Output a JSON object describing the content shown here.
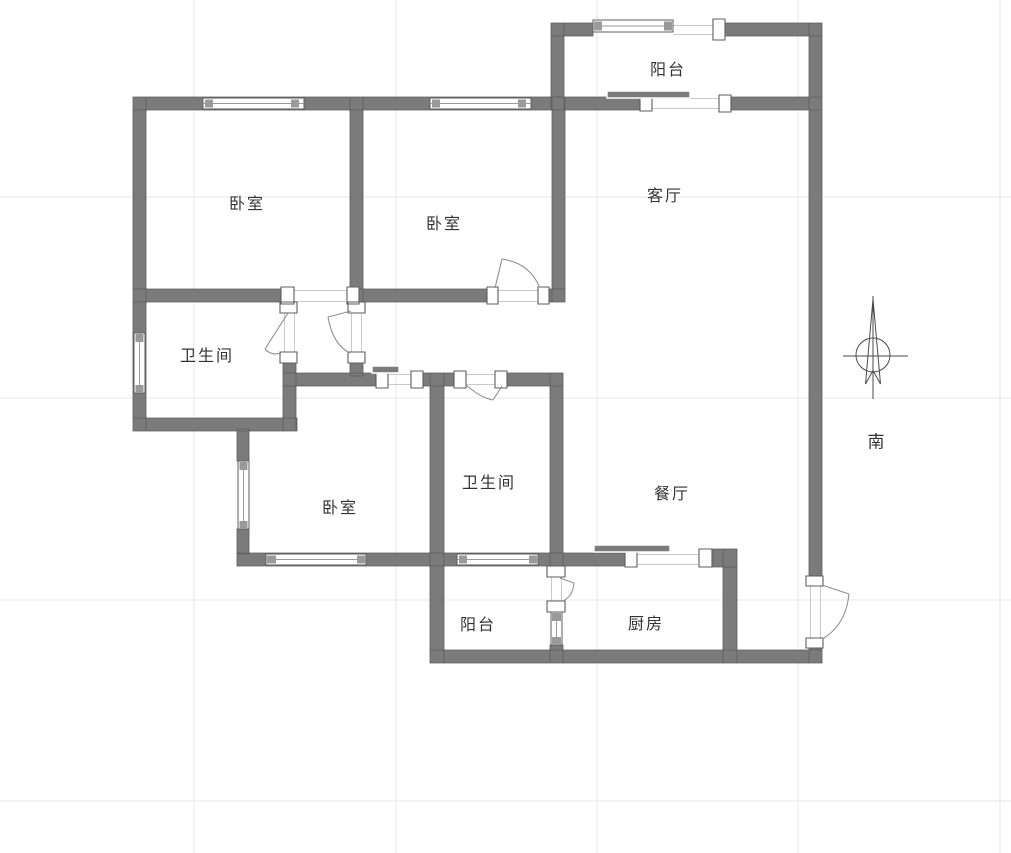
{
  "rooms": {
    "balcony_top": "阳台",
    "bedroom_top_left": "卧室",
    "bedroom_top_middle": "卧室",
    "living_room": "客厅",
    "bathroom_left": "卫生间",
    "bedroom_bottom": "卧室",
    "bathroom_middle": "卫生间",
    "dining_room": "餐厅",
    "balcony_bottom": "阳台",
    "kitchen": "厨房"
  },
  "compass": {
    "south_label": "南"
  },
  "colors": {
    "wall": "#7b7b7b",
    "wall-edge": "#5e5e5e",
    "opening-line": "#c9c9c9",
    "door-line": "#8f8f8f",
    "window-cap": "#9a9a9a",
    "grid": "#e7e7e7",
    "text": "#333333",
    "compass-line": "#4a4a4a",
    "background": "#ffffff"
  }
}
